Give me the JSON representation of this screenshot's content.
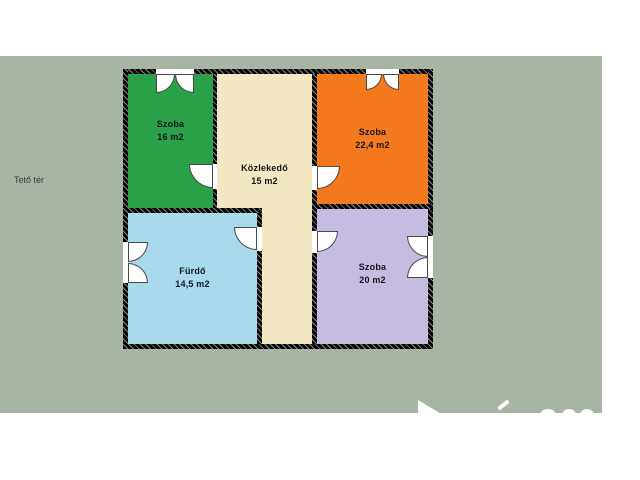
{
  "page": {
    "area_label": "Tető tér"
  },
  "colors": {
    "canvas": "#ffffff",
    "backdrop": "#a8b4a4",
    "wall": "#141414",
    "leaf_outline": "#4a4a4a",
    "opening": "#ffffff",
    "label_text": "#15151f",
    "watermark": "#fdfefd"
  },
  "rooms": {
    "szoba_top_left": {
      "name": "Szoba",
      "area": "16 m2",
      "color": "#2aa148"
    },
    "kozlekedo": {
      "name": "Közlekedő",
      "area": "15 m2",
      "color": "#f2e8c2"
    },
    "szoba_top_right": {
      "name": "Szoba",
      "area": "22,4 m2",
      "color": "#f5791d"
    },
    "furdo": {
      "name": "Fürdő",
      "area": "14,5 m2",
      "color": "#a8daec"
    },
    "szoba_bottom_right": {
      "name": "Szoba",
      "area": "20 m2",
      "color": "#c6bce0"
    }
  }
}
